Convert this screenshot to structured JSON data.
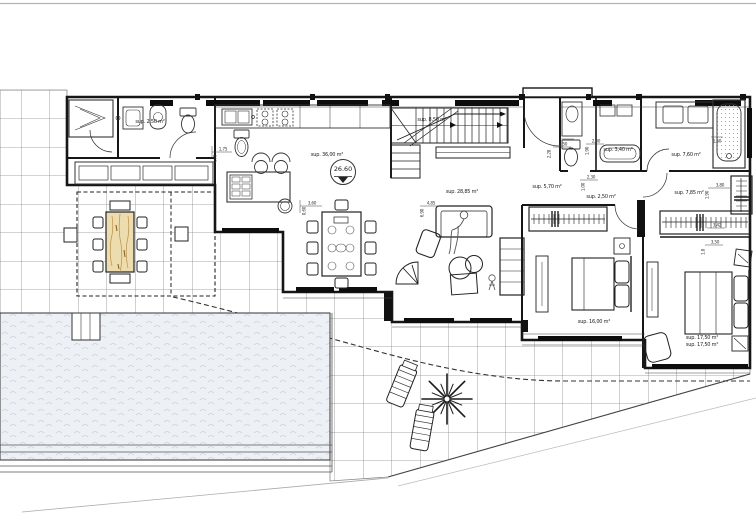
{
  "plan": {
    "level_marker": {
      "value": "26.60"
    },
    "area_labels": [
      {
        "text": "sup. 2,50 m²",
        "x": 150,
        "y": 122
      },
      {
        "text": "sup. 36,00 m²",
        "x": 327,
        "y": 155
      },
      {
        "text": "sup. 8,50 m²",
        "x": 432,
        "y": 120
      },
      {
        "text": "sup. 28,85 m²",
        "x": 462,
        "y": 192
      },
      {
        "text": "sup. 5,70 m²",
        "x": 547,
        "y": 187
      },
      {
        "text": "sup. 2,50 m²",
        "x": 601,
        "y": 197
      },
      {
        "text": "sup. 3,40 m²",
        "x": 618,
        "y": 150
      },
      {
        "text": "sup. 7,60 m²",
        "x": 686,
        "y": 155
      },
      {
        "text": "sup. 7,85 m²",
        "x": 689,
        "y": 193
      },
      {
        "text": "sup. 16,00 m²",
        "x": 594,
        "y": 322
      },
      {
        "text": "sup. 17,50 m²",
        "x": 702,
        "y": 338
      },
      {
        "text": "sup. 17,50 m²",
        "x": 702,
        "y": 345
      }
    ],
    "dimension_labels": [
      {
        "text": "1,75",
        "x": 223,
        "y": 149,
        "rot": 0
      },
      {
        "text": "4,70",
        "x": 215,
        "y": 159,
        "rot": -90
      },
      {
        "text": "3,60",
        "x": 312,
        "y": 203,
        "rot": 0
      },
      {
        "text": "0,60",
        "x": 304,
        "y": 211,
        "rot": -90
      },
      {
        "text": "4,85",
        "x": 431,
        "y": 203,
        "rot": 0
      },
      {
        "text": "6,90",
        "x": 422,
        "y": 213,
        "rot": -90
      },
      {
        "text": "1,50",
        "x": 563,
        "y": 144,
        "rot": 0
      },
      {
        "text": "2,28",
        "x": 549,
        "y": 154,
        "rot": -90
      },
      {
        "text": "2,00",
        "x": 596,
        "y": 141,
        "rot": 0
      },
      {
        "text": "1,90",
        "x": 587,
        "y": 151,
        "rot": -90
      },
      {
        "text": "2,30",
        "x": 591,
        "y": 177,
        "rot": 0
      },
      {
        "text": "1,00",
        "x": 583,
        "y": 187,
        "rot": -90
      },
      {
        "text": "1,50",
        "x": 717,
        "y": 141,
        "rot": 0
      },
      {
        "text": "3,80",
        "x": 720,
        "y": 185,
        "rot": 0
      },
      {
        "text": "1,90",
        "x": 707,
        "y": 195,
        "rot": -90
      },
      {
        "text": "3,42",
        "x": 717,
        "y": 225,
        "rot": 0
      },
      {
        "text": "3,50",
        "x": 715,
        "y": 242,
        "rot": 0
      },
      {
        "text": "1,8",
        "x": 703,
        "y": 252,
        "rot": -90
      }
    ],
    "colors": {
      "wall_line": "#161616",
      "grid_line": "#8a8a8a",
      "pool_water": "#edf1f6",
      "pool_wave": "#c8d2dd",
      "wood_fill": "#ecdcae",
      "wood_grain": "#b98f4a",
      "sheet_frame": "#b3b3b3",
      "annotation": "#222222"
    }
  }
}
